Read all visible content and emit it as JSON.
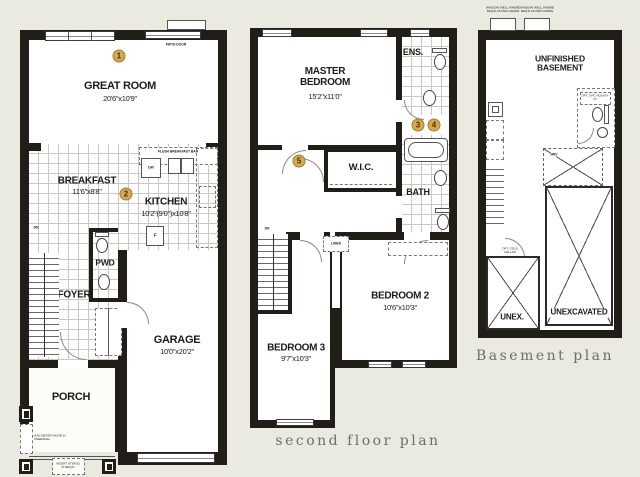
{
  "colors": {
    "background": "#EBEAE0",
    "wall": "#211E1A",
    "marker_fill": "#D5A851",
    "marker_border": "#A37E2E",
    "caption": "#6B7163"
  },
  "first_floor": {
    "markers": {
      "m1": "1",
      "m2": "2"
    },
    "patio_door_label": "PATIO DOOR",
    "great_room": {
      "name": "GREAT ROOM",
      "dims": "20'6\"x10'9\""
    },
    "breakfast": {
      "name": "BREAKFAST",
      "dims": "11'6\"x8'8\""
    },
    "kitchen": {
      "name": "KITCHEN",
      "dims": "10'2\"(9'0\")x10'8\""
    },
    "flush_bar_label": "FLUSH BREAKFAST BAR",
    "dw_label": "DW",
    "fridge_label": "F",
    "pwd_label": "PWD",
    "foyer_label": "FOYER",
    "dn_label": "DN",
    "garage": {
      "name": "GARAGE",
      "dims": "10'0\"x20'2\""
    },
    "porch_label": "PORCH",
    "gas_meter_label": "GAS METER NICHE IN KNEEWALL",
    "steps_label": "INSERT STEP(S) IF REQ'D"
  },
  "second_floor": {
    "markers": {
      "m3": "3",
      "m4": "4",
      "m5": "5"
    },
    "master_bedroom": {
      "name": "MASTER BEDROOM",
      "dims": "15'2\"x11'0\""
    },
    "ens_label": "ENS.",
    "wic_label": "W.I.C.",
    "double_hanging_label": "DOUBLE HANGING",
    "bath_label": "BATH",
    "linen_label": "LINEN",
    "dn_label": "DN",
    "bedroom2": {
      "name": "BEDROOM 2",
      "dims": "10'6\"x10'3\""
    },
    "bedroom3": {
      "name": "BEDROOM 3",
      "dims": "9'7\"x10'3\""
    },
    "caption": "second floor plan"
  },
  "basement": {
    "room_label_line1": "UNFINISHED",
    "room_label_line2": "BASEMENT",
    "window_well_label": "WINDOW WELL WHERE REQ'D AS PER GRADE",
    "rough_in_label": "OPT. 3-PC ROUGH-IN",
    "hrv_label": "HRV",
    "cold_cellar_label": "OPT. COLD CELLAR",
    "unex_label": "UNEX.",
    "unexcavated_label": "UNEXCAVATED",
    "caption": "Basement plan"
  }
}
